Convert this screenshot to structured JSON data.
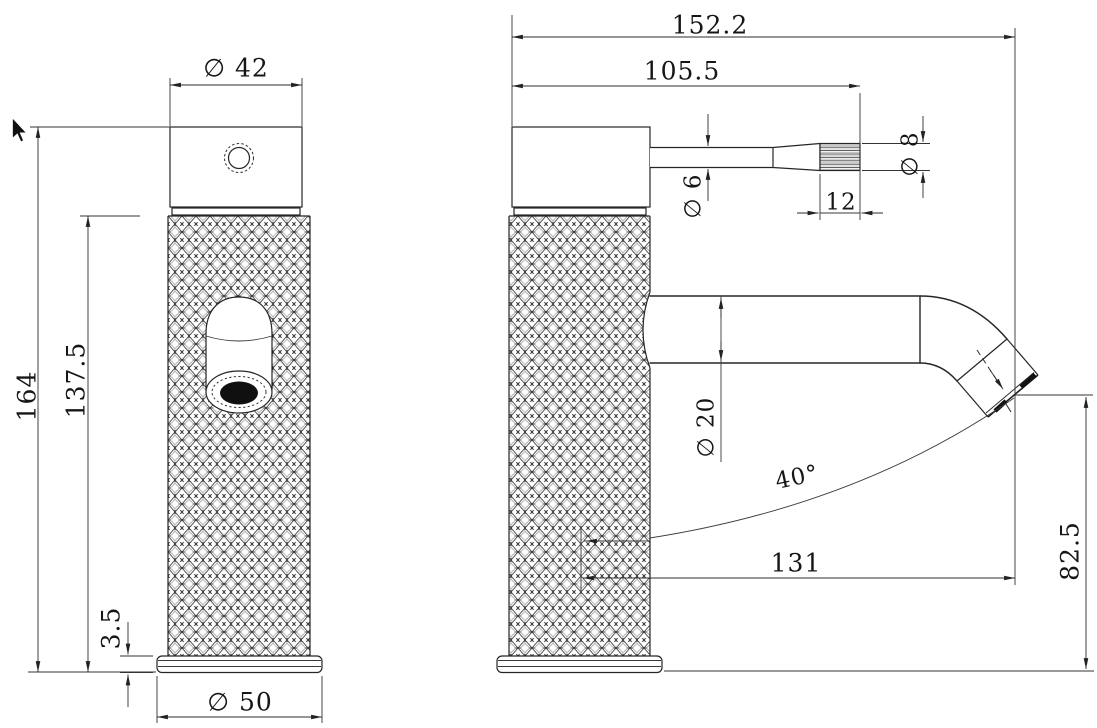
{
  "drawing": {
    "front_view": {
      "cap_diameter": "∅ 42",
      "total_height": "164",
      "body_height": "137.5",
      "base_thickness": "3.5",
      "base_diameter": "∅ 50"
    },
    "side_view": {
      "total_length": "152.2",
      "upper_length": "105.5",
      "handle_stem_diameter": "∅ 6",
      "handle_tip_diameter": "∅ 8",
      "handle_knurl_length": "12",
      "spout_diameter": "∅ 20",
      "spout_angle": "40°",
      "spout_reach": "131",
      "outlet_height": "82.5"
    }
  }
}
